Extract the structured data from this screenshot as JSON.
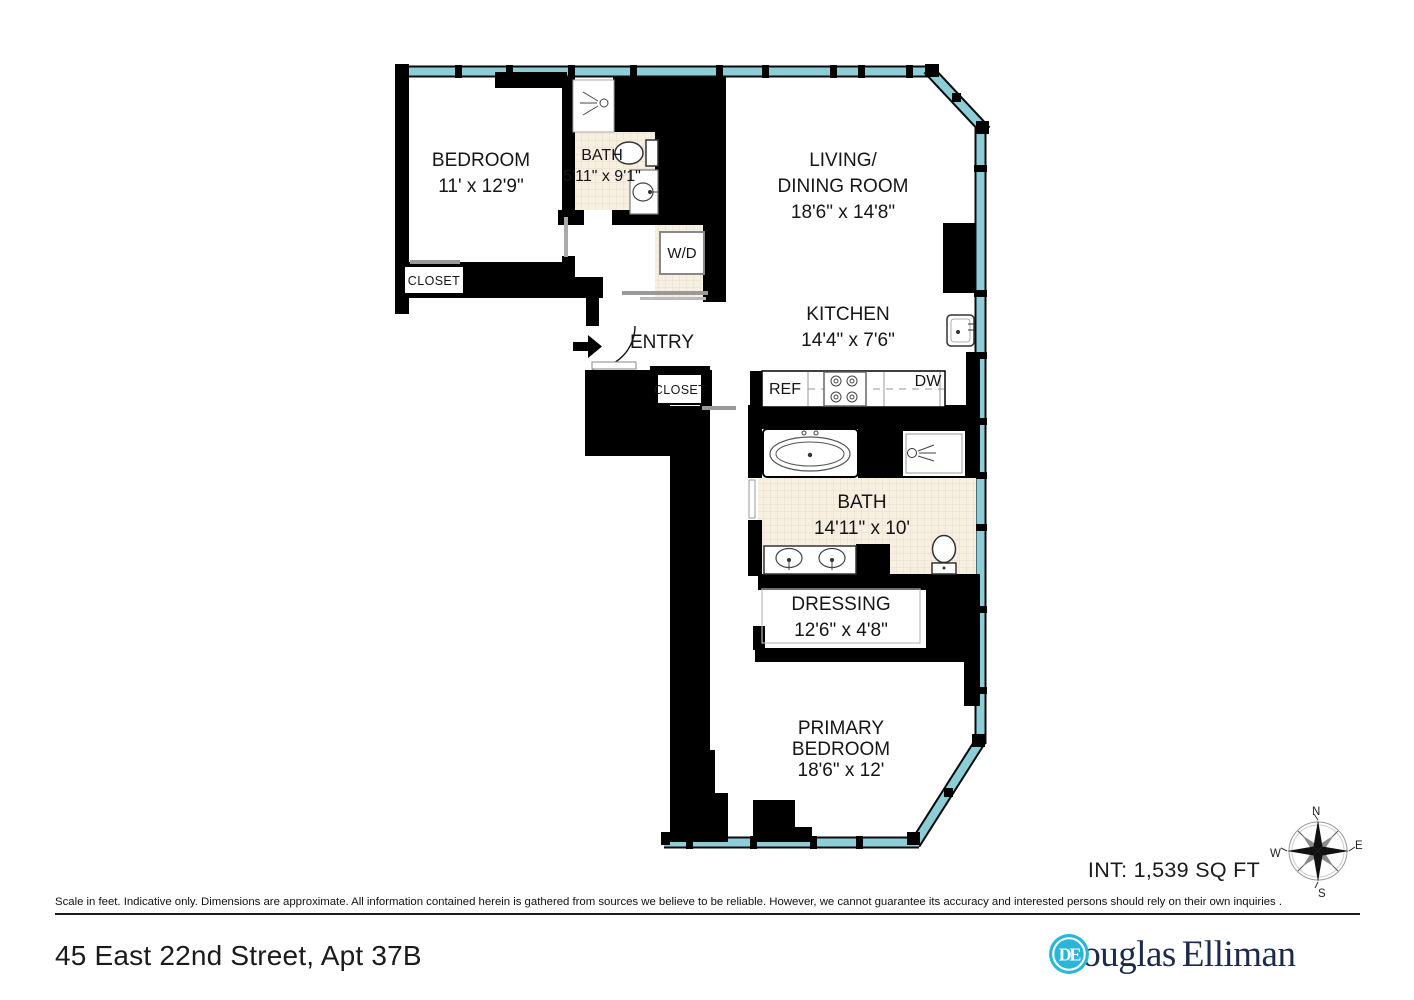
{
  "plan": {
    "rooms": {
      "bedroom": {
        "name": "BEDROOM",
        "dims": "11' x 12'9\""
      },
      "bath_small": {
        "name": "BATH",
        "dims": "5'11\" x 9'1\""
      },
      "living": {
        "name": "LIVING/",
        "name2": "DINING ROOM",
        "dims": "18'6\" x 14'8\""
      },
      "kitchen": {
        "name": "KITCHEN",
        "dims": "14'4\" x 7'6\""
      },
      "bath_primary": {
        "name": "BATH",
        "dims": "14'11\" x 10'"
      },
      "dressing": {
        "name": "DRESSING",
        "dims": "12'6\" x 4'8\""
      },
      "primary_bedroom": {
        "name": "PRIMARY",
        "name2": "BEDROOM",
        "dims": "18'6\" x 12'"
      }
    },
    "features": {
      "entry": "ENTRY",
      "closet_bedroom": "CLOSET",
      "closet_hall": "CLOSET",
      "washer_dryer": "W/D",
      "refrigerator": "REF",
      "dishwasher": "DW"
    },
    "area": "INT: 1,539 SQ FT",
    "compass": {
      "north": "N",
      "east": "E",
      "south": "S",
      "west": "W"
    }
  },
  "footer": {
    "disclaimer": "Scale in feet. Indicative only. Dimensions are approximate. All information contained herein is gathered from sources we believe to be reliable. However, we cannot guarantee its accuracy and interested persons should rely on their own inquiries .",
    "address": "45 East 22nd Street, Apt 37B"
  },
  "brand": {
    "monogram": "DE",
    "name_first": "Douglas",
    "name_second": "Elliman"
  },
  "colors": {
    "wall": "#000000",
    "window_glass": "#8ccdd8",
    "tile": "#f7efe1",
    "brand_cyan": "#29b7d8",
    "brand_navy": "#1c2b4a"
  }
}
